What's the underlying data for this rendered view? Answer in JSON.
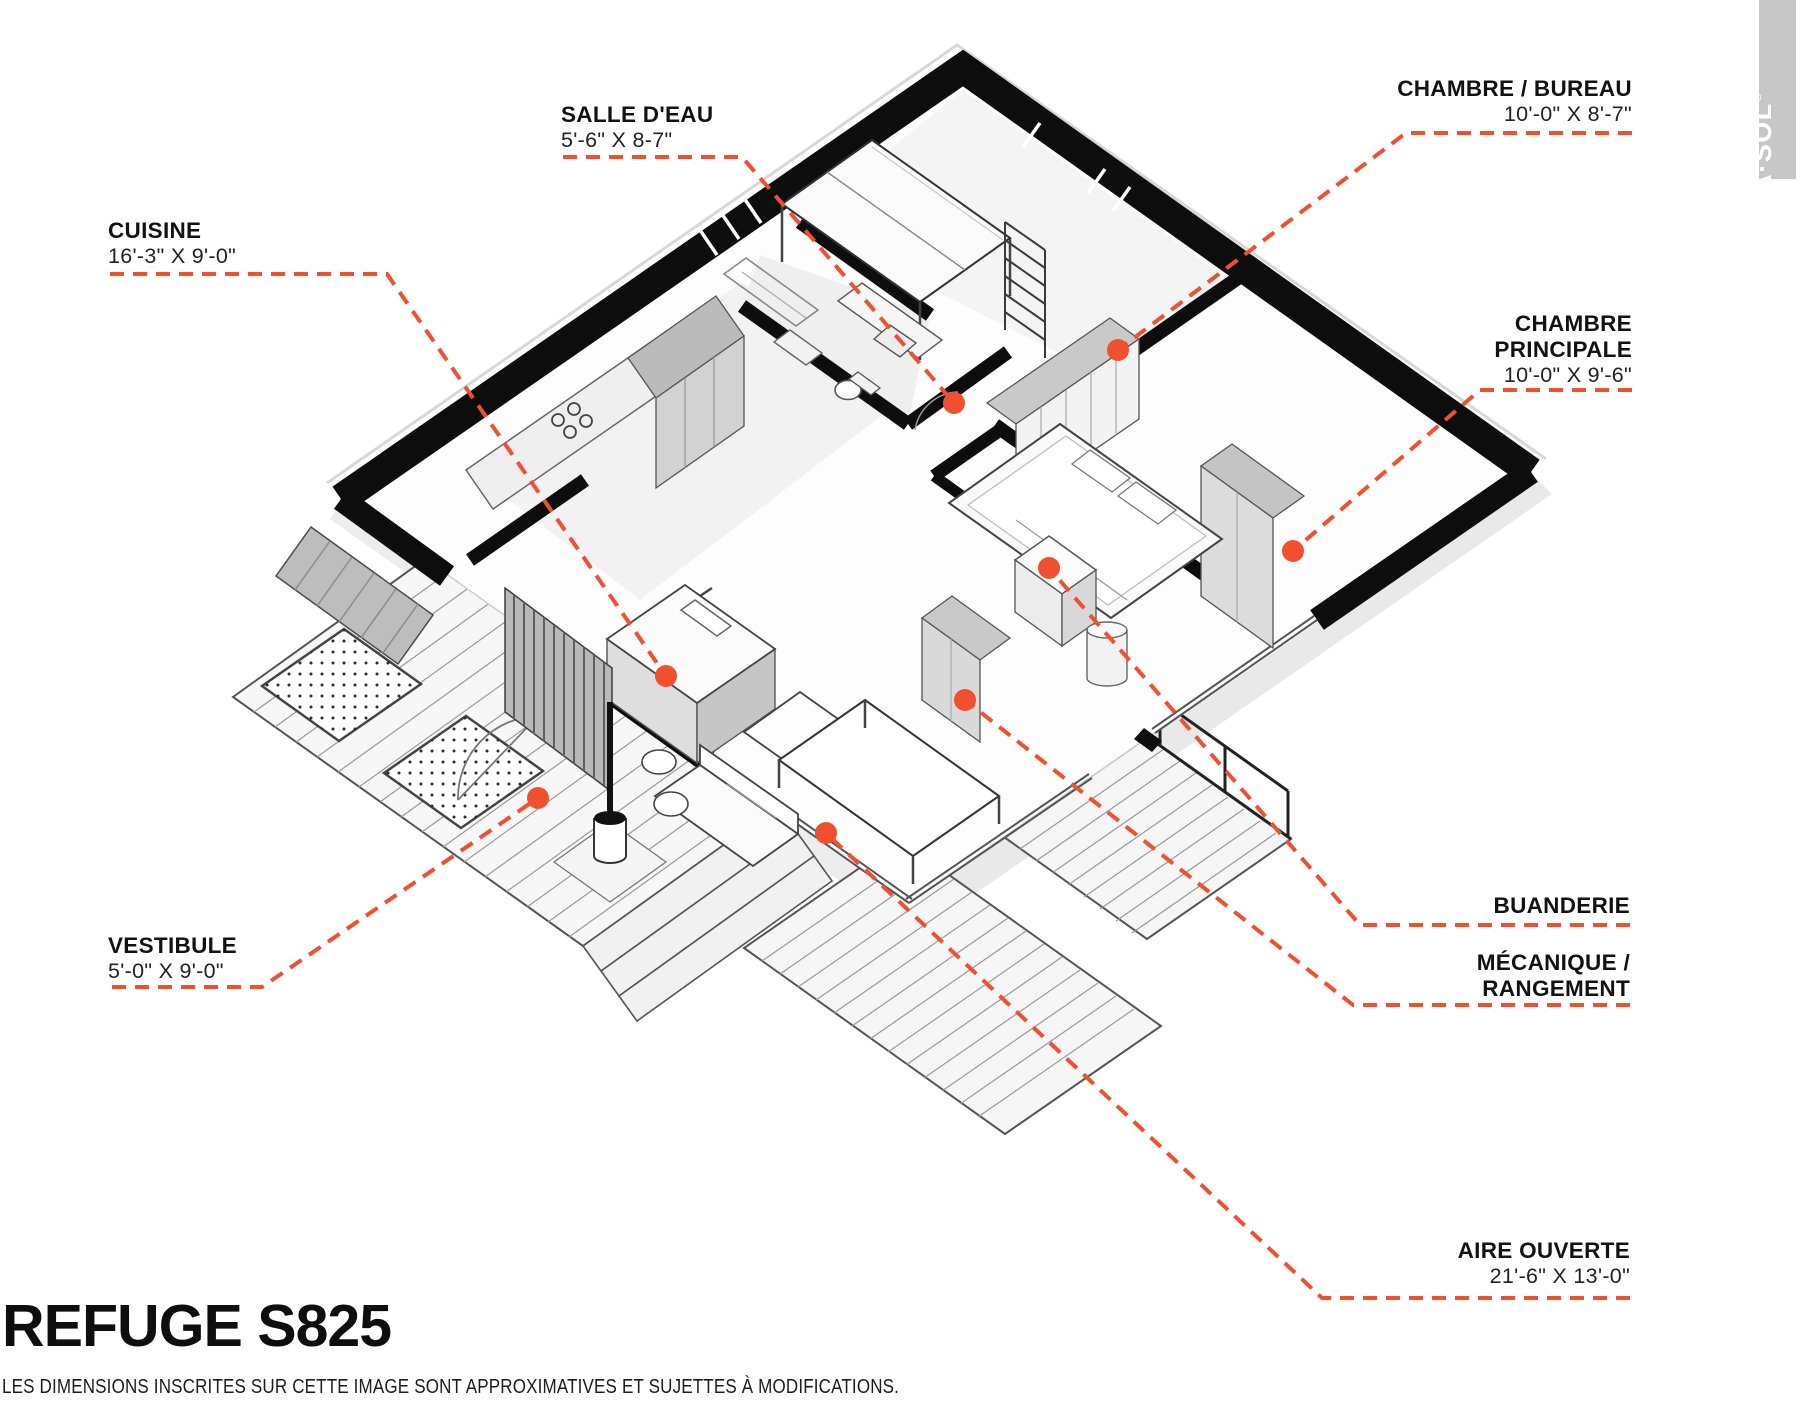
{
  "colors": {
    "accent": "#F0502E",
    "wall": "#0D0D0D",
    "text": "#161616",
    "brand_bar": "#C7C7C7"
  },
  "brand": {
    "name": "PARA·SOL",
    "registered": "®"
  },
  "title": "REFUGE S825",
  "disclaimer": "LES DIMENSIONS INSCRITES SUR CETTE IMAGE SONT APPROXIMATIVES ET SUJETTES À MODIFICATIONS.",
  "rooms": {
    "cuisine": {
      "name": "CUISINE",
      "dims": "16'-3\" X 9'-0\""
    },
    "salle_deau": {
      "name": "SALLE D'EAU",
      "dims": "5'-6\" X 8-7\""
    },
    "chambre_bureau": {
      "name": "CHAMBRE / BUREAU",
      "dims": "10'-0\" X 8'-7\""
    },
    "chambre_principale": {
      "name": "CHAMBRE PRINCIPALE",
      "dims": "10'-0\" X 9'-6\""
    },
    "vestibule": {
      "name": "VESTIBULE",
      "dims": "5'-0\" X 9'-0\""
    },
    "buanderie": {
      "name": "BUANDERIE",
      "dims": ""
    },
    "mecanique": {
      "name": "MÉCANIQUE / RANGEMENT",
      "dims": ""
    },
    "aire_ouverte": {
      "name": "AIRE OUVERTE",
      "dims": "21'-6\" X 13'-0\""
    }
  },
  "callouts": [
    {
      "room": "cuisine",
      "line": [
        [
          110,
          274
        ],
        [
          387,
          274
        ],
        [
          666,
          676
        ]
      ],
      "dot": [
        666,
        676
      ]
    },
    {
      "room": "salle_deau",
      "line": [
        [
          563,
          157
        ],
        [
          742,
          157
        ],
        [
          954,
          403
        ]
      ],
      "dot": [
        954,
        403
      ]
    },
    {
      "room": "chambre_bureau",
      "line": [
        [
          1632,
          133
        ],
        [
          1406,
          133
        ],
        [
          1118,
          350
        ]
      ],
      "dot": [
        1118,
        350
      ]
    },
    {
      "room": "chambre_principale",
      "line": [
        [
          1632,
          390
        ],
        [
          1480,
          390
        ],
        [
          1293,
          551
        ]
      ],
      "dot": [
        1293,
        551
      ]
    },
    {
      "room": "vestibule",
      "line": [
        [
          112,
          987
        ],
        [
          262,
          987
        ],
        [
          538,
          798
        ]
      ],
      "dot": [
        538,
        798
      ]
    },
    {
      "room": "buanderie",
      "line": [
        [
          1630,
          925
        ],
        [
          1360,
          925
        ],
        [
          1049,
          568
        ]
      ],
      "dot": [
        1049,
        568
      ]
    },
    {
      "room": "mecanique",
      "line": [
        [
          1630,
          1005
        ],
        [
          1353,
          1005
        ],
        [
          965,
          700
        ]
      ],
      "dot": [
        965,
        700
      ]
    },
    {
      "room": "aire_ouverte",
      "line": [
        [
          1630,
          1298
        ],
        [
          1322,
          1298
        ],
        [
          826,
          833
        ]
      ],
      "dot": [
        826,
        833
      ]
    }
  ]
}
